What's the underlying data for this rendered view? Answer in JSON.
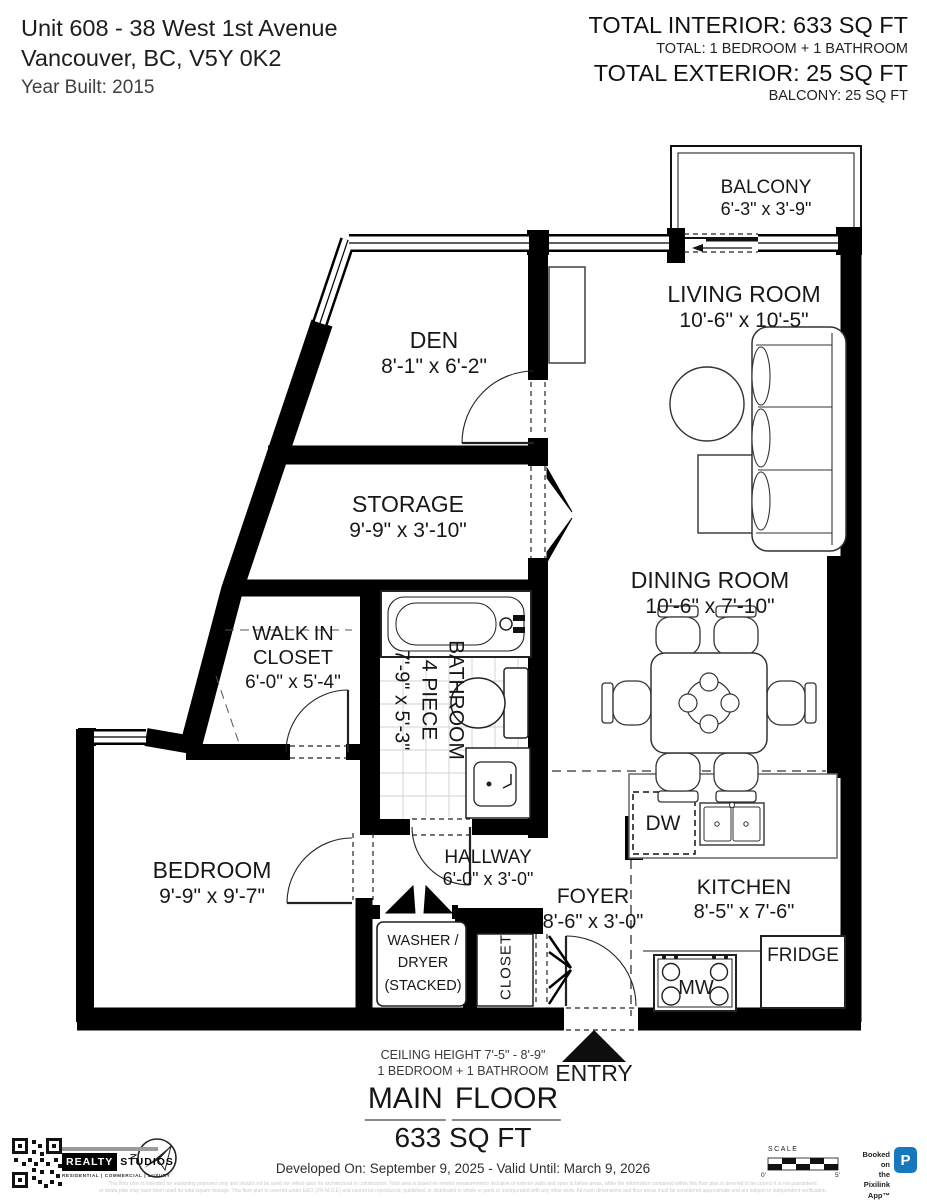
{
  "header": {
    "address_line1": "Unit 608 - 38 West 1st Avenue",
    "address_line2": "Vancouver, BC, V5Y 0K2",
    "year_built": "Year Built: 2015",
    "total_interior": "TOTAL INTERIOR: 633 SQ FT",
    "total_rooms": "TOTAL: 1 BEDROOM + 1 BATHROOM",
    "total_exterior": "TOTAL EXTERIOR: 25 SQ FT",
    "exterior_detail": "BALCONY: 25 SQ FT"
  },
  "rooms": {
    "balcony": {
      "name": "BALCONY",
      "dims": "6'-3\" x 3'-9\""
    },
    "living_room": {
      "name": "LIVING ROOM",
      "dims": "10'-6\" x 10'-5\""
    },
    "den": {
      "name": "DEN",
      "dims": "8'-1\" x 6'-2\""
    },
    "storage": {
      "name": "STORAGE",
      "dims": "9'-9\" x 3'-10\""
    },
    "dining_room": {
      "name": "DINING ROOM",
      "dims": "10'-6\" x 7'-10\""
    },
    "walk_in_closet": {
      "name_line1": "WALK IN",
      "name_line2": "CLOSET",
      "dims": "6'-0\" x 5'-4\""
    },
    "bathroom": {
      "name": "BATHROOM",
      "type": "4 PIECE",
      "dims": "7'-9\" x 5'-3\""
    },
    "bedroom": {
      "name": "BEDROOM",
      "dims": "9'-9\" x 9'-7\""
    },
    "hallway": {
      "name": "HALLWAY",
      "dims": "6'-0\" x 3'-0\""
    },
    "foyer": {
      "name": "FOYER",
      "dims": "8'-6\" x 3'-0\""
    },
    "kitchen": {
      "name": "KITCHEN",
      "dims": "8'-5\" x 7'-6\""
    }
  },
  "fixtures": {
    "dw": "DW",
    "fridge": "FRIDGE",
    "mw": "MW",
    "closet": "CLOSET",
    "entry": "ENTRY",
    "washer_line1": "WASHER /",
    "washer_line2": "DRYER",
    "washer_line3": "(STACKED)"
  },
  "summary": {
    "ceiling_height": "CEILING HEIGHT 7'-5\" - 8'-9\"",
    "bed_bath": "1 BEDROOM + 1 BATHROOM",
    "floor_word1": "MAIN",
    "floor_word2": "FLOOR",
    "floor_area": "633 SQ FT"
  },
  "footer": {
    "developed_on": "Developed On: September 9, 2025 - Valid Until: March 9, 2026",
    "brand_realty": "REALTY",
    "brand_studios": "STUDIOS",
    "brand_tagline": "RESIDENTIAL | COMMERCIAL | LUXURY",
    "compass_n": "N",
    "scale_label": "SCALE",
    "scale_start": "0'",
    "scale_end": "5'",
    "booked_line1": "Booked on",
    "booked_line2": "the Pixilink App™",
    "app_letter": "P",
    "app_color": "#1878be",
    "disclaimer_line1": "This floor plan is intended for marketing purposes only and should not be used nor relied upon for architectural or construction. Total area is based on interior measurements inclusive of exterior walls and open to below areas, while the information contained within this floor plan is deemed to be correct it is not guaranteed.",
    "disclaimer_line2": "or strata plan may have been used for total square footage. This floor plan is covered under E&O (3% M.O.E) and cannot be reproduced, published, or distributed in whole or parts or incorporated with any other work. All room dimensions and floor areas must be considered approximate and are subject to independent verification."
  }
}
